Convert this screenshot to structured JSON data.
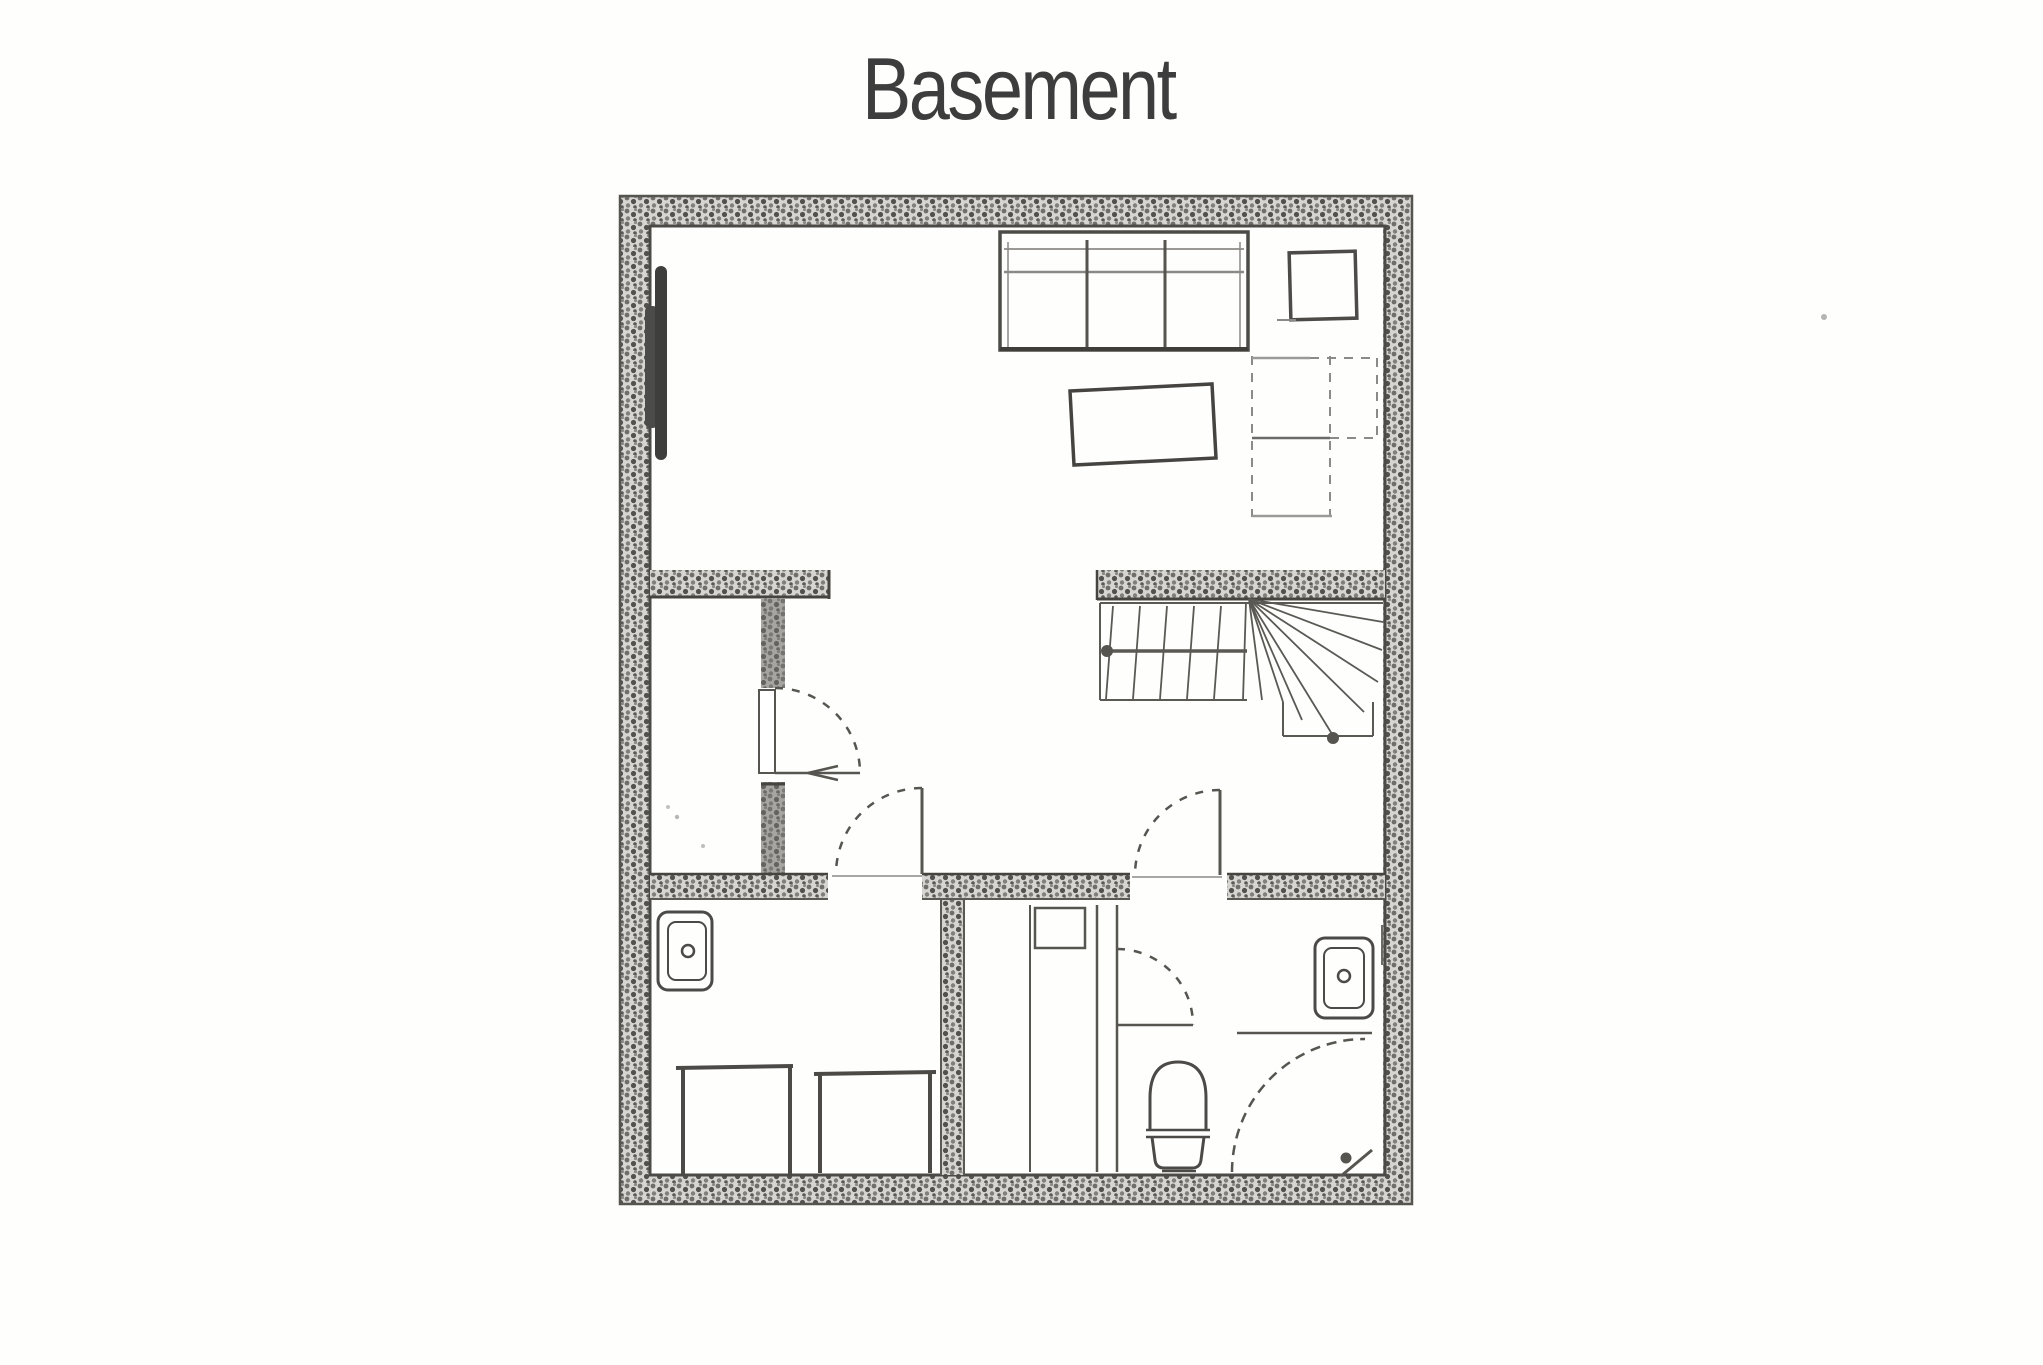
{
  "page": {
    "title": "Basement",
    "background_color": "#fefefd",
    "ink_color": "#3d3d3d"
  },
  "floor_plan": {
    "label": "Basement floor plan",
    "drawing_style": "scanned hand-drawn plan with stippled masonry walls",
    "wall_fill_color": "#d6d5d2",
    "wall_dot_color": "#55544f",
    "line_color": "#4c4b48",
    "rooms": [
      {
        "name": "recreation-room",
        "position": "top, full width",
        "furniture": [
          "three-seat-sofa",
          "side-table",
          "coffee-table",
          "dashed-cabinet-outline",
          "wall-mounted-unit-on-left-wall"
        ]
      },
      {
        "name": "storage-closet",
        "position": "middle-left",
        "features": [
          "hinged door swinging into hallway"
        ]
      },
      {
        "name": "hallway",
        "position": "middle",
        "features": [
          "door to laundry room",
          "door to bathroom"
        ]
      },
      {
        "name": "staircase",
        "position": "middle-right",
        "features": [
          "straight treads",
          "winder treads fanning at corner",
          "lower landing",
          "newel posts"
        ]
      },
      {
        "name": "laundry-room",
        "position": "bottom-left",
        "fixtures": [
          "utility-sink",
          "washer",
          "dryer"
        ]
      },
      {
        "name": "bathroom",
        "position": "bottom-right",
        "fixtures": [
          "shower-stall-with-partition",
          "shower-door",
          "toilet",
          "vanity-sink",
          "corner-door-swing-arc"
        ]
      }
    ]
  }
}
